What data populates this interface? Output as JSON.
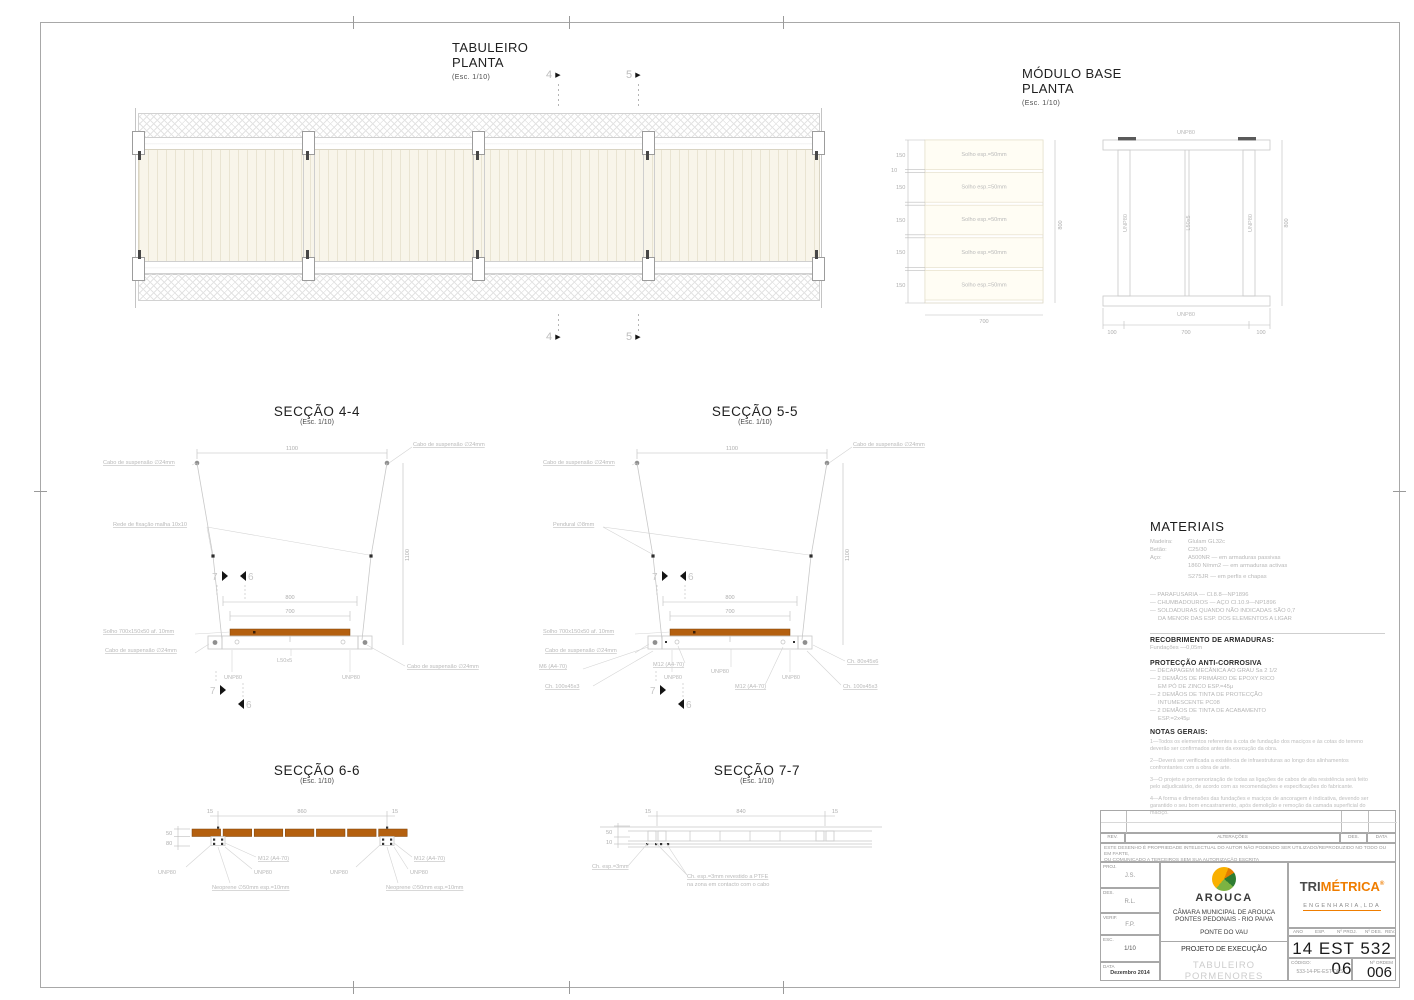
{
  "page": {
    "plan": {
      "title": "TABULEIRO",
      "subtitle": "PLANTA",
      "scale": "(Esc. 1/10)",
      "marker4": "4",
      "marker5": "5"
    },
    "modulo": {
      "title": "MÓDULO BASE",
      "subtitle": "PLANTA",
      "scale": "(Esc. 1/10)",
      "plank_label": "Solho  esp.=50mm",
      "dim_150": "150",
      "dim_gap": "10",
      "dim_700": "700",
      "dim_800": "800",
      "dim_100": "100",
      "unp80": "UNP80",
      "l50x5": "L50x5"
    },
    "sec44": {
      "title": "SECÇÃO 4-4",
      "scale": "(Esc. 1/10)",
      "cable": "Cabo de suspensão ∅24mm",
      "mesh": "Rede de fixação malha 10x10",
      "solho": "Solho 700x150x50 af. 10mm",
      "unp80": "UNP80",
      "l50x5": "L50x5",
      "dim1100": "1100",
      "dim800": "800",
      "dim700": "700",
      "m7": "7",
      "m6": "6"
    },
    "sec55": {
      "title": "SECÇÃO 5-5",
      "scale": "(Esc. 1/10)",
      "cable": "Cabo de suspensão ∅24mm",
      "pendural": "Pendural ∅8mm",
      "solho": "Solho 700x150x50 af. 10mm",
      "m6bolt": "M6 (A4-70)",
      "m12bolt": "M12 (A4-70)",
      "ch100": "Ch. 100x45x3",
      "ch80": "Ch. 80x45x6",
      "unp80": "UNP80",
      "dim1100": "1100",
      "dim800": "800",
      "dim700": "700",
      "m7": "7",
      "m6": "6"
    },
    "sec66": {
      "title": "SECÇÃO 6-6",
      "scale": "(Esc. 1/10)",
      "dim860": "860",
      "dim15": "15",
      "dim50": "50",
      "dim80": "80",
      "m12bolt": "M12 (A4-70)",
      "unp80": "UNP80",
      "neoprene": "Neoprene ∅50mm esp.=10mm"
    },
    "sec77": {
      "title": "SECÇÃO 7-7",
      "scale": "(Esc. 1/10)",
      "dim840": "840",
      "dim15": "15",
      "dim50": "50",
      "dim10": "10",
      "ch3": "Ch. esp.=3mm",
      "ch3ptfe1": "Ch. esp.=3mm revestido a PTFE",
      "ch3ptfe2": "na zona em contacto com o cabo"
    },
    "materiais": {
      "title": "MATERIAIS",
      "l1a": "Madeira:",
      "l1b": "Glulam GL32c",
      "l2a": "Betão:",
      "l2b": "C25/30",
      "l3a": "Aço:",
      "l3b": "A500NR  —  em armaduras passivas",
      "l4b": "1860 N/mm2  —  em armaduras activas",
      "l5b": "S275JR  —  em perfis e chapas",
      "b1": "—  PARAFUSARIA — Cl.8.8—NP1896",
      "b2": "—  CHUMBADOUROS — AÇO Cl.10.9—NP1896",
      "b3": "—  SOLDADURAS QUANDO NÃO INDICADAS SÃO 0,7",
      "b4": "DA MENOR DAS ESP. DOS ELEMENTOS A LIGAR",
      "rec_title": "RECOBRIMENTO DE ARMADURAS:",
      "rec_val": "Fundações          —0,05m",
      "prot_title": "PROTECÇÃO ANTI-CORROSIVA",
      "p1": "—  DECAPAGEM MECÂNICA AO GRAU Sa 2 1/2",
      "p2": "—  2 DEMÃOS DE PRIMÁRIO DE EPOXY RICO",
      "p3": "EM PÓ DE ZINCO ESP.=45μ",
      "p4": "—  2 DEMÃOS DE TINTA DE PROTECÇÃO",
      "p5": "INTUMESCENTE PC08",
      "p6": "—  2 DEMÃOS DE TINTA DE ACABAMENTO",
      "p7": "ESP.=2x45μ",
      "notas_title": "NOTAS GERAIS:",
      "n1": "1—Todos os elementos referentes à cota de fundação dos maciços e às cotas do terreno deverão ser confirmados antes da execução da obra.",
      "n2": "2—Deverá ser verificada a existência de infraestruturas ao longo dos alinhamentos confrontantes com a obra de arte.",
      "n3": "3—O projeto e pormenorização de todas as ligações de cabos de alta resistência será feito pelo adjudicatário, de acordo com as recomendações e especificações do fabricante.",
      "n4": "4—A forma e dimensões das fundações e maciços de ancoragem é indicativa, devendo ser garantido o seu bom encastramento, após demolição e remoção da camada superficial do maciço."
    },
    "titleblock": {
      "rev": "REV.",
      "alteracoes": "ALTERAÇÕES",
      "des": "DES.",
      "data": "DATA",
      "disclaimer1": "ESTE DESENHO É PROPRIEDADE INTELECTUAL DO AUTOR NÃO PODENDO SER UTILIZADO/REPRODUZIDO NO TODO OU EM PARTE,",
      "disclaimer2": "OU COMUNICADO A TERCEIROS SEM SUA AUTORIZAÇÃO ESCRITA",
      "proj_label": "PROJ.",
      "proj_val": "J.S.",
      "des_label": "DES.",
      "des_val": "R.L.",
      "verif_label": "VERIF.",
      "verif_val": "F.P.",
      "esc_label": "ESC.",
      "esc_val": "1/10",
      "data_label": "DATA",
      "data_val": "Dezembro 2014",
      "arouca": "AROUCA",
      "camara": "CÂMARA MUNICIPAL DE AROUCA",
      "pontes": "PONTES PEDONAIS  - RIO PAIVA",
      "ponte": "PONTE DO VAU",
      "projeto": "PROJETO DE EXECUÇÃO",
      "tab1": "TABULEIRO",
      "tab2": "PORMENORES",
      "tri1": "TRI",
      "tri2": "MÉTRICA",
      "tri3": "ENGENHARIA,LDA",
      "hdr_ano": "ANO",
      "hdr_esp": "ESP.",
      "hdr_nproj": "Nº PROJ.",
      "hdr_ndes": "Nº DES.",
      "hdr_rev": "REV.",
      "num": "14 EST 532 06",
      "codigo_label": "CÓDIGO:",
      "codigo_val": "533-14-PE-EST-DES",
      "ordem_label": "Nº ORDEM",
      "ordem_val": "006"
    }
  }
}
